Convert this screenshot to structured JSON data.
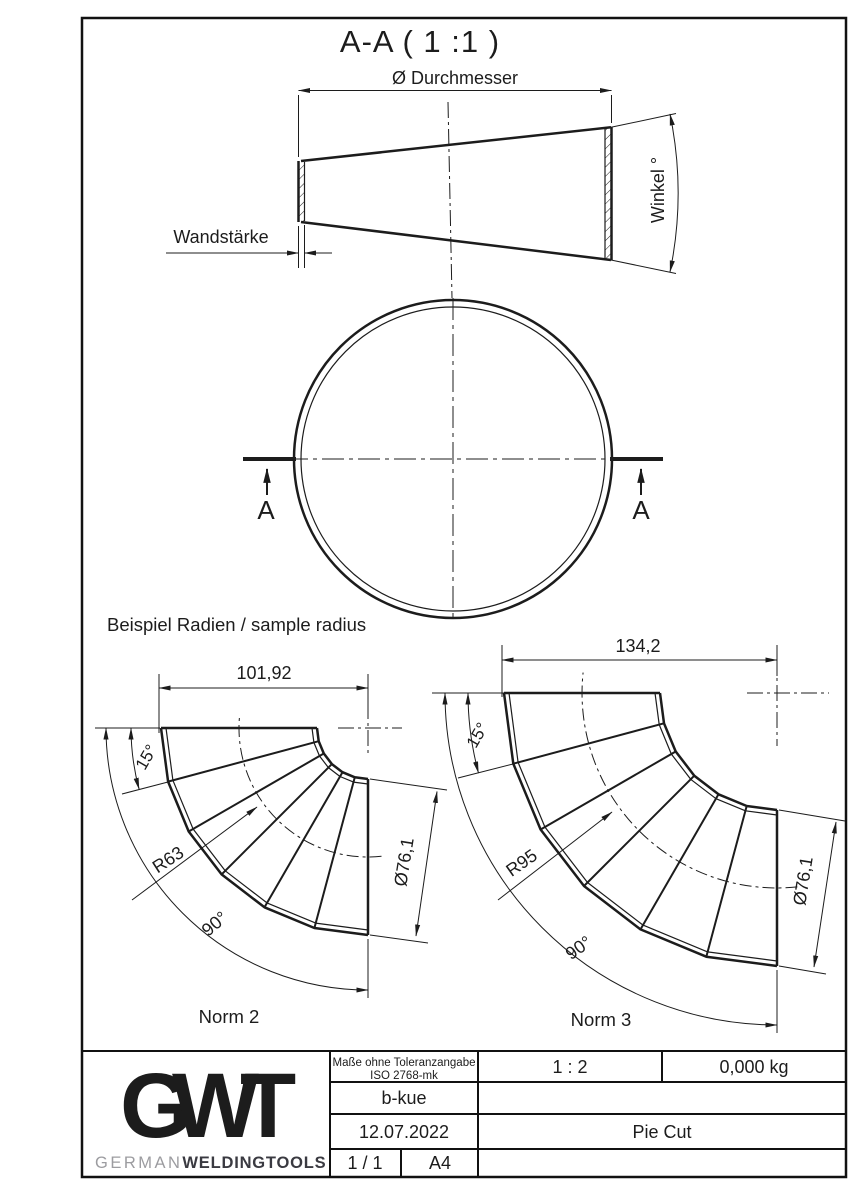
{
  "drawing": {
    "section_title": "A-A ( 1 :1 )",
    "cone": {
      "diameter_label": "Ø Durchmesser",
      "wall_label": "Wandstärke",
      "angle_label": "Winkel °"
    },
    "section_cut": {
      "label": "A"
    },
    "samples_heading": "Beispiel Radien / sample radius",
    "norm2": {
      "caption": "Norm 2",
      "length": "101,92",
      "seg_angle": "15°",
      "radius": "R63",
      "bend_angle": "90°",
      "diameter": "Ø76,1"
    },
    "norm3": {
      "caption": "Norm 3",
      "length": "134,2",
      "seg_angle": "15°",
      "radius": "R95",
      "bend_angle": "90°",
      "diameter": "Ø76,1"
    }
  },
  "title_block": {
    "tolerance1": "Maße ohne Toleranzangabe",
    "tolerance2": "ISO 2768-mk",
    "creator": "b-kue",
    "date": "12.07.2022",
    "page": "1 / 1",
    "format": "A4",
    "scale": "1 : 2",
    "weight": "0,000 kg",
    "title": "Pie Cut",
    "logo_g": "G",
    "logo_w": "W",
    "logo_t": "T",
    "brand_light": "GERMAN",
    "brand_bold": "WELDINGTOOLS"
  },
  "colors": {
    "line": "#1c1c1c",
    "logo_dark": "#3a3a41",
    "logo_mid": "#5d5d64",
    "logo_t": "#47474e",
    "brand_gray": "#9c9ca0"
  }
}
